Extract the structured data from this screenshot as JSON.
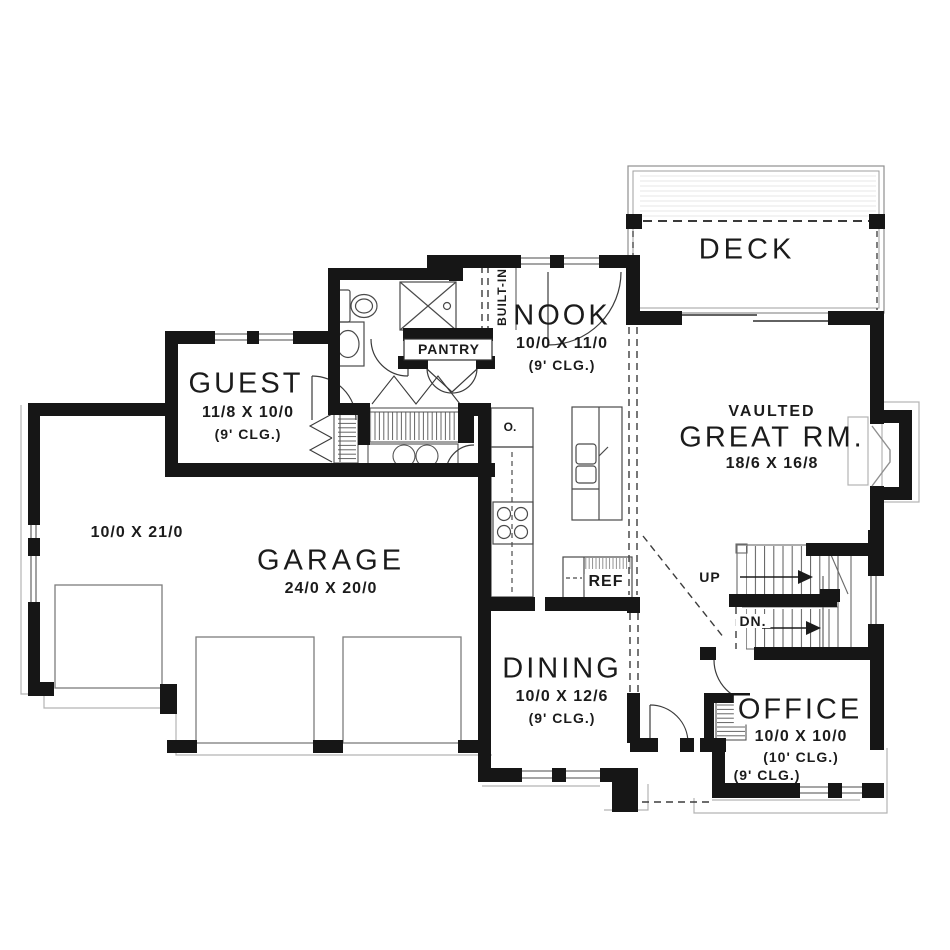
{
  "rooms": {
    "deck": {
      "name": "DECK"
    },
    "nook": {
      "name": "NOOK",
      "dim": "10/0 X 11/0",
      "ceiling": "(9' CLG.)"
    },
    "guest": {
      "name": "GUEST",
      "dim": "11/8 X 10/0",
      "ceiling": "(9' CLG.)"
    },
    "great": {
      "prefix": "VAULTED",
      "name": "GREAT RM.",
      "dim": "18/6 X 16/8"
    },
    "garage": {
      "name": "GARAGE",
      "dim": "24/0 X 20/0"
    },
    "bay": {
      "dim": "10/0 X 21/0"
    },
    "dining": {
      "name": "DINING",
      "dim": "10/0 X 12/6",
      "ceiling": "(9' CLG.)"
    },
    "office": {
      "name": "OFFICE",
      "dim": "10/0 X 10/0",
      "ceiling": "(10' CLG.)"
    },
    "porch": {
      "ceiling": "(9' CLG.)"
    }
  },
  "labels": {
    "pantry": "PANTRY",
    "built_in": "BUILT-IN",
    "ref": "REF",
    "oven": "O.",
    "up": "UP",
    "down": "DN."
  },
  "colors": {
    "wall": "#161616",
    "line": "#2f2f2f",
    "light_line": "#8f8f8f",
    "background": "#ffffff"
  }
}
